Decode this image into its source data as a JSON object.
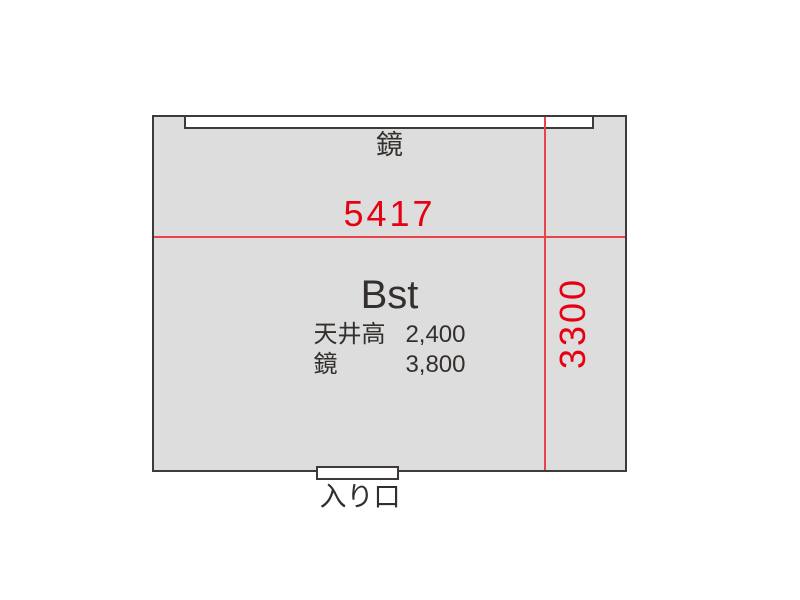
{
  "plan": {
    "room_name": "Bst",
    "width_value": "5417",
    "height_value": "3300",
    "mirror_label": "鏡",
    "entrance_label": "入り口",
    "specs": [
      {
        "label": "天井高",
        "value": "2,400"
      },
      {
        "label": "鏡",
        "value": "3,800"
      }
    ],
    "colors": {
      "room_fill": "#dedddd",
      "outline": "#3e3a39",
      "dimension_text_red": "#e60012",
      "dimension_line_red": "#e8424b",
      "text_dark": "#332f2d"
    }
  }
}
